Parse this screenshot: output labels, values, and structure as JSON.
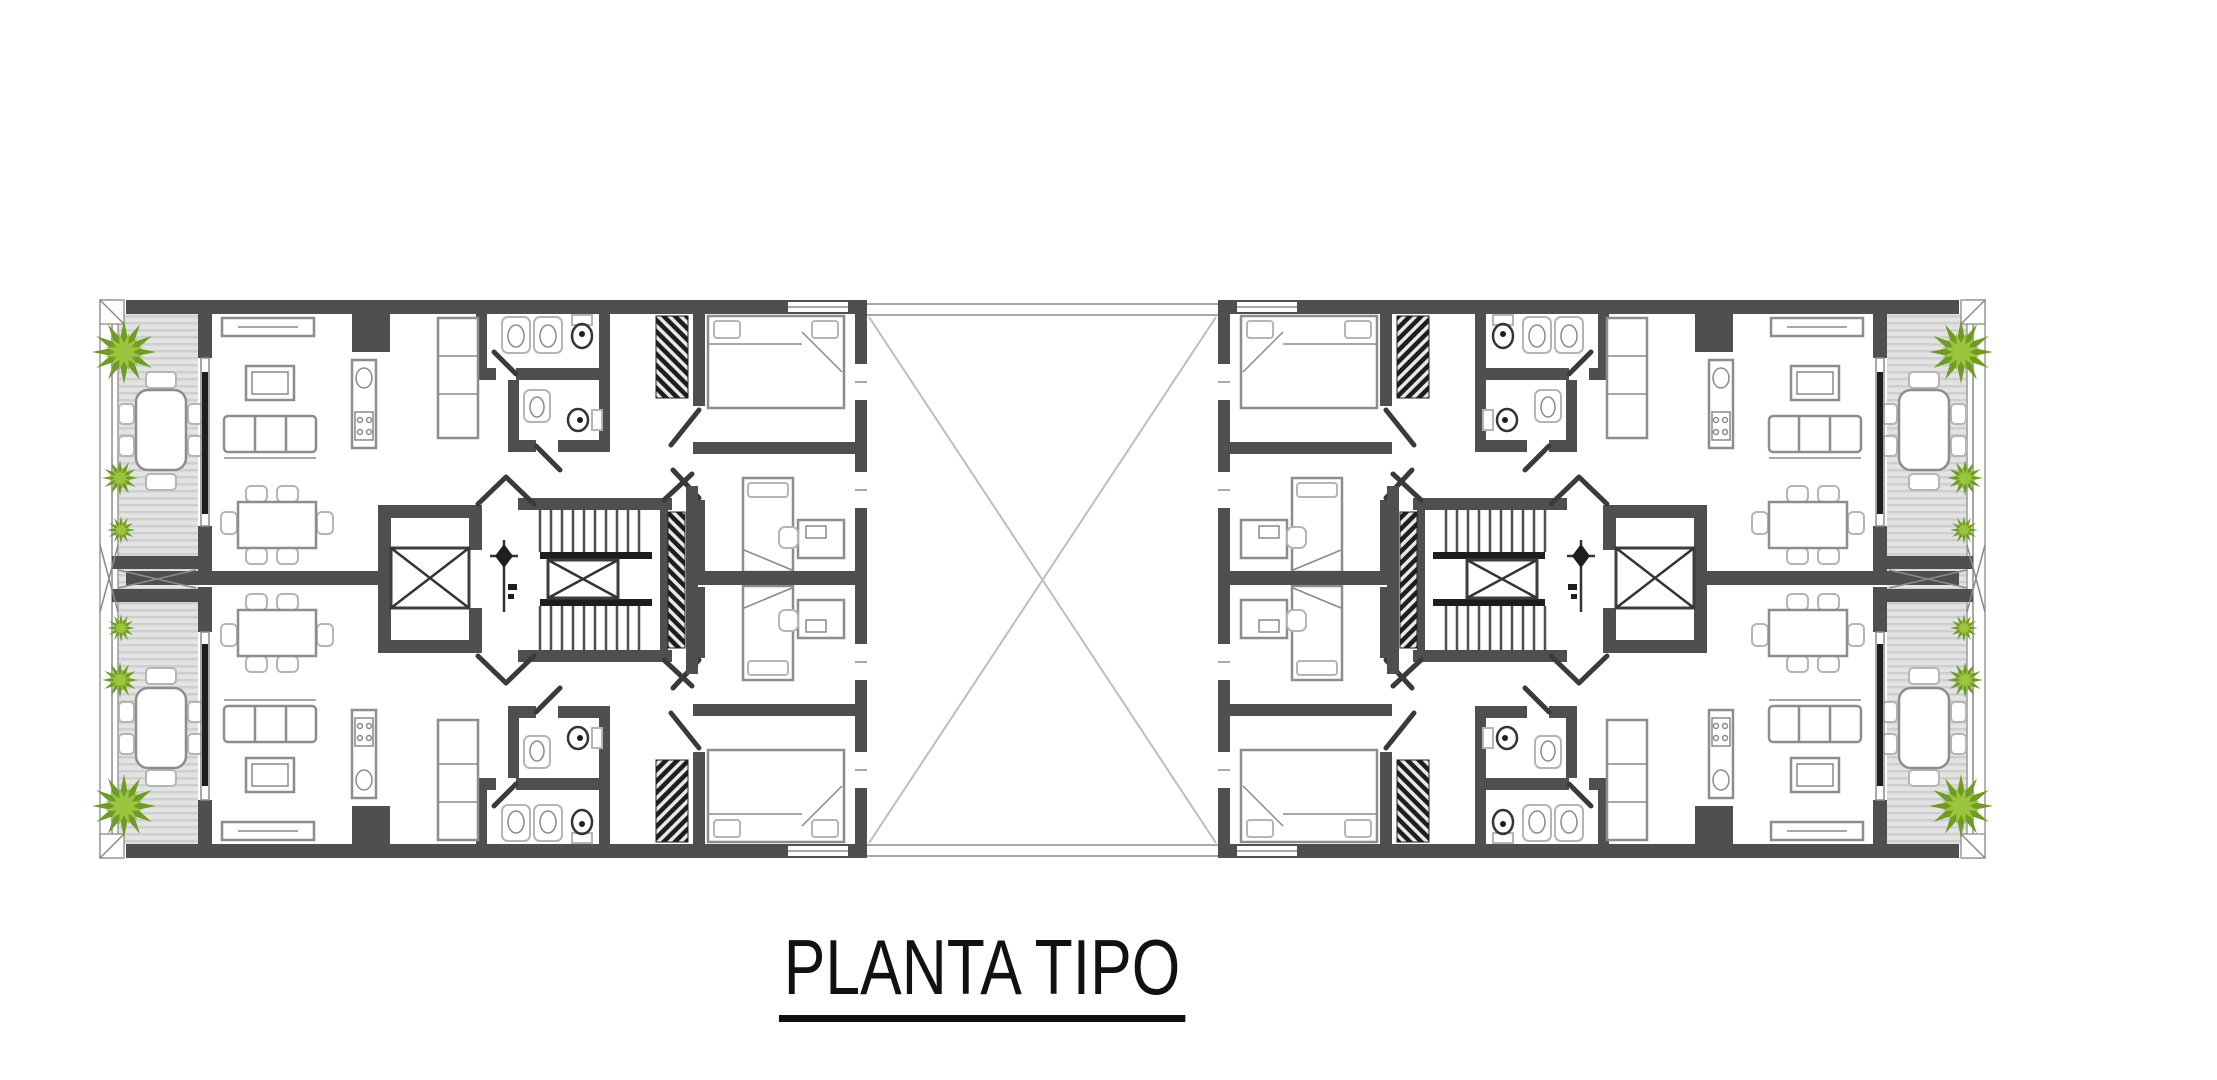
{
  "title": {
    "text": "PLANTA TIPO"
  },
  "colors": {
    "background": "#ffffff",
    "wall": "#4f4f4f",
    "wall_light": "#8a8a8a",
    "furniture": "#8d8d8d",
    "furniture_light": "#b5b5b5",
    "door": "#3a3a3a",
    "black_detail": "#1e1e1e",
    "balcony_floor": "#e3e3e3",
    "balcony_stripe": "#cfcfcf",
    "courtyard_line": "#bdbdbd",
    "plant_dark": "#6f9c26",
    "plant_light": "#9cc43e",
    "text": "#111111"
  },
  "plan": {
    "type": "residential-typical-floor-plan",
    "apartment_units": 4,
    "stair_cores": 2,
    "elevators": 2,
    "central_courtyard": 1,
    "terraces_with_plants": 4,
    "visible_symbols": [
      "sofa",
      "coffee-table",
      "tv-cabinet",
      "dining-table-with-chairs",
      "terrace-table-with-chairs",
      "kitchen-counter-with-sink-and-stove",
      "kitchen-tall-unit",
      "washbasin",
      "toilet",
      "wardrobe-hatch",
      "double-bed",
      "single-bed",
      "desk-with-chair",
      "staircase",
      "elevator-with-x",
      "courtyard-void-x",
      "plant",
      "section-marker",
      "door-leaf",
      "window-opening"
    ]
  }
}
